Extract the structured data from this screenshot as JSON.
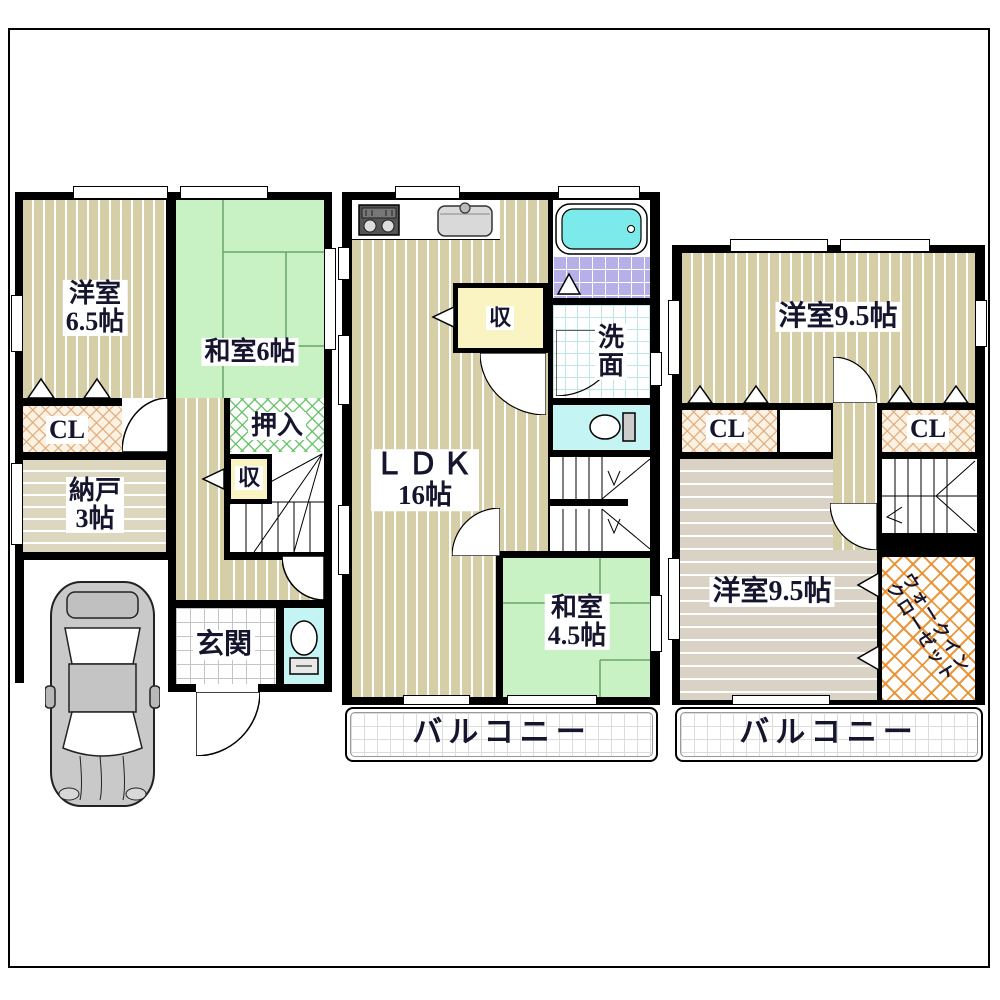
{
  "document": {
    "type": "floor-plan",
    "floors": [
      "1F",
      "2F",
      "3F"
    ]
  },
  "floor1": {
    "western_room_line1": "洋室",
    "western_room_line2": "6.5帖",
    "japanese_room": "和室6帖",
    "closet": "CL",
    "storage_line1": "納戸",
    "storage_line2": "3帖",
    "oshiire": "押入",
    "small_closet": "収",
    "entrance": "玄関"
  },
  "floor2": {
    "ldk_line1": "ＬＤＫ",
    "ldk_line2": "16帖",
    "small_closet": "収",
    "washroom_line1": "洗",
    "washroom_line2": "面",
    "japanese_room_line1": "和室",
    "japanese_room_line2": "4.5帖",
    "balcony": "バルコニー"
  },
  "floor3": {
    "western_room_upper": "洋室9.5帖",
    "western_room_lower": "洋室9.5帖",
    "closet_left": "CL",
    "closet_right": "CL",
    "wic_line1": "ウォークイン",
    "wic_line2": "クローゼット",
    "balcony": "バルコニー"
  },
  "icons": {
    "car": "car-top-view-icon",
    "bathtub": "bathtub-icon",
    "toilet_floor1": "toilet-icon",
    "toilet_floor2": "toilet-icon",
    "stove": "gas-stove-icon",
    "sink": "kitchen-sink-icon"
  },
  "colors": {
    "wall": "#000000",
    "wood_floor_tan": "#d6cea6",
    "storage_beige": "#ded7c0",
    "room_gray_tan": "#d9d2c5",
    "tatami_green": "#c9f2c4",
    "closet_hatch_orange": "#dfa674",
    "oshiire_hatch_green": "#5abe5a",
    "wic_hatch_orange": "#e88c28",
    "small_closet_yellow": "#faf3c2",
    "toilet_cyan": "#c5f4f4",
    "bath_tile_purple": "#b7b0e8",
    "bathtub_cyan": "#7ceaea",
    "label_text": "#15152e"
  }
}
